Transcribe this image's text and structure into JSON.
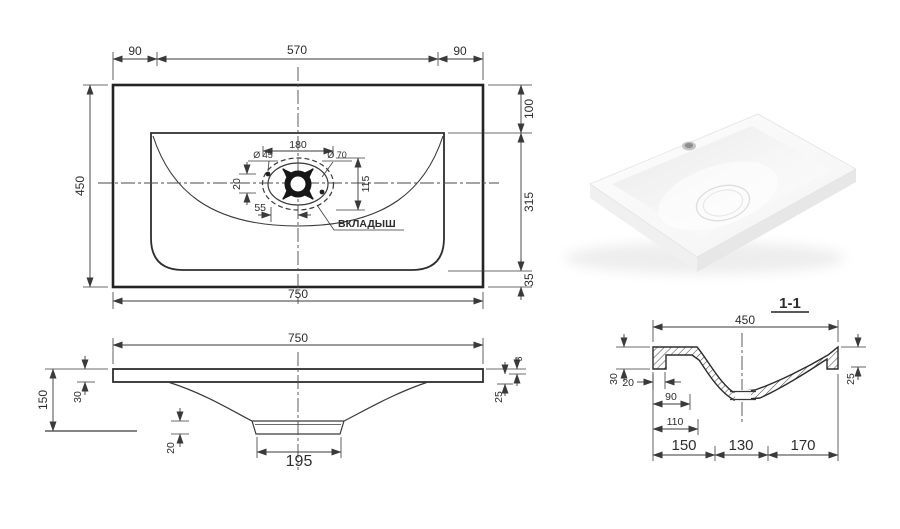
{
  "drawing": {
    "plan": {
      "top_left_overhang": "90",
      "top_center_span": "570",
      "top_right_overhang": "90",
      "depth": "450",
      "right_rim_offset": "100",
      "right_basin_span": "315",
      "right_bottom_margin": "35",
      "width": "750",
      "insert_width": "180",
      "insert_height": "115",
      "overflow_dia": "Ø 45",
      "drain_dia": "Ø 70",
      "vertical_offset": "20",
      "horizontal_offset": "55",
      "insert_callout": "ВКЛАДЫШ"
    },
    "front": {
      "width": "750",
      "height": "150",
      "edge_height": "30",
      "bottom_offset": "20",
      "drain_flat_width": "195",
      "rim_lip": "5",
      "slab_thickness": "25"
    },
    "section": {
      "title": "1-1",
      "depth": "450",
      "edge_height": "30",
      "rim_width": "20",
      "offset_90": "90",
      "offset_110": "110",
      "segment_left": "150",
      "segment_center": "130",
      "segment_right": "170",
      "right_edge_height": "25"
    }
  },
  "colors": {
    "line": "#3a3a3a",
    "heavy_line": "#232323",
    "text": "#2d2d2d",
    "background": "#ffffff",
    "render_shadow": "#e9e9e9"
  }
}
